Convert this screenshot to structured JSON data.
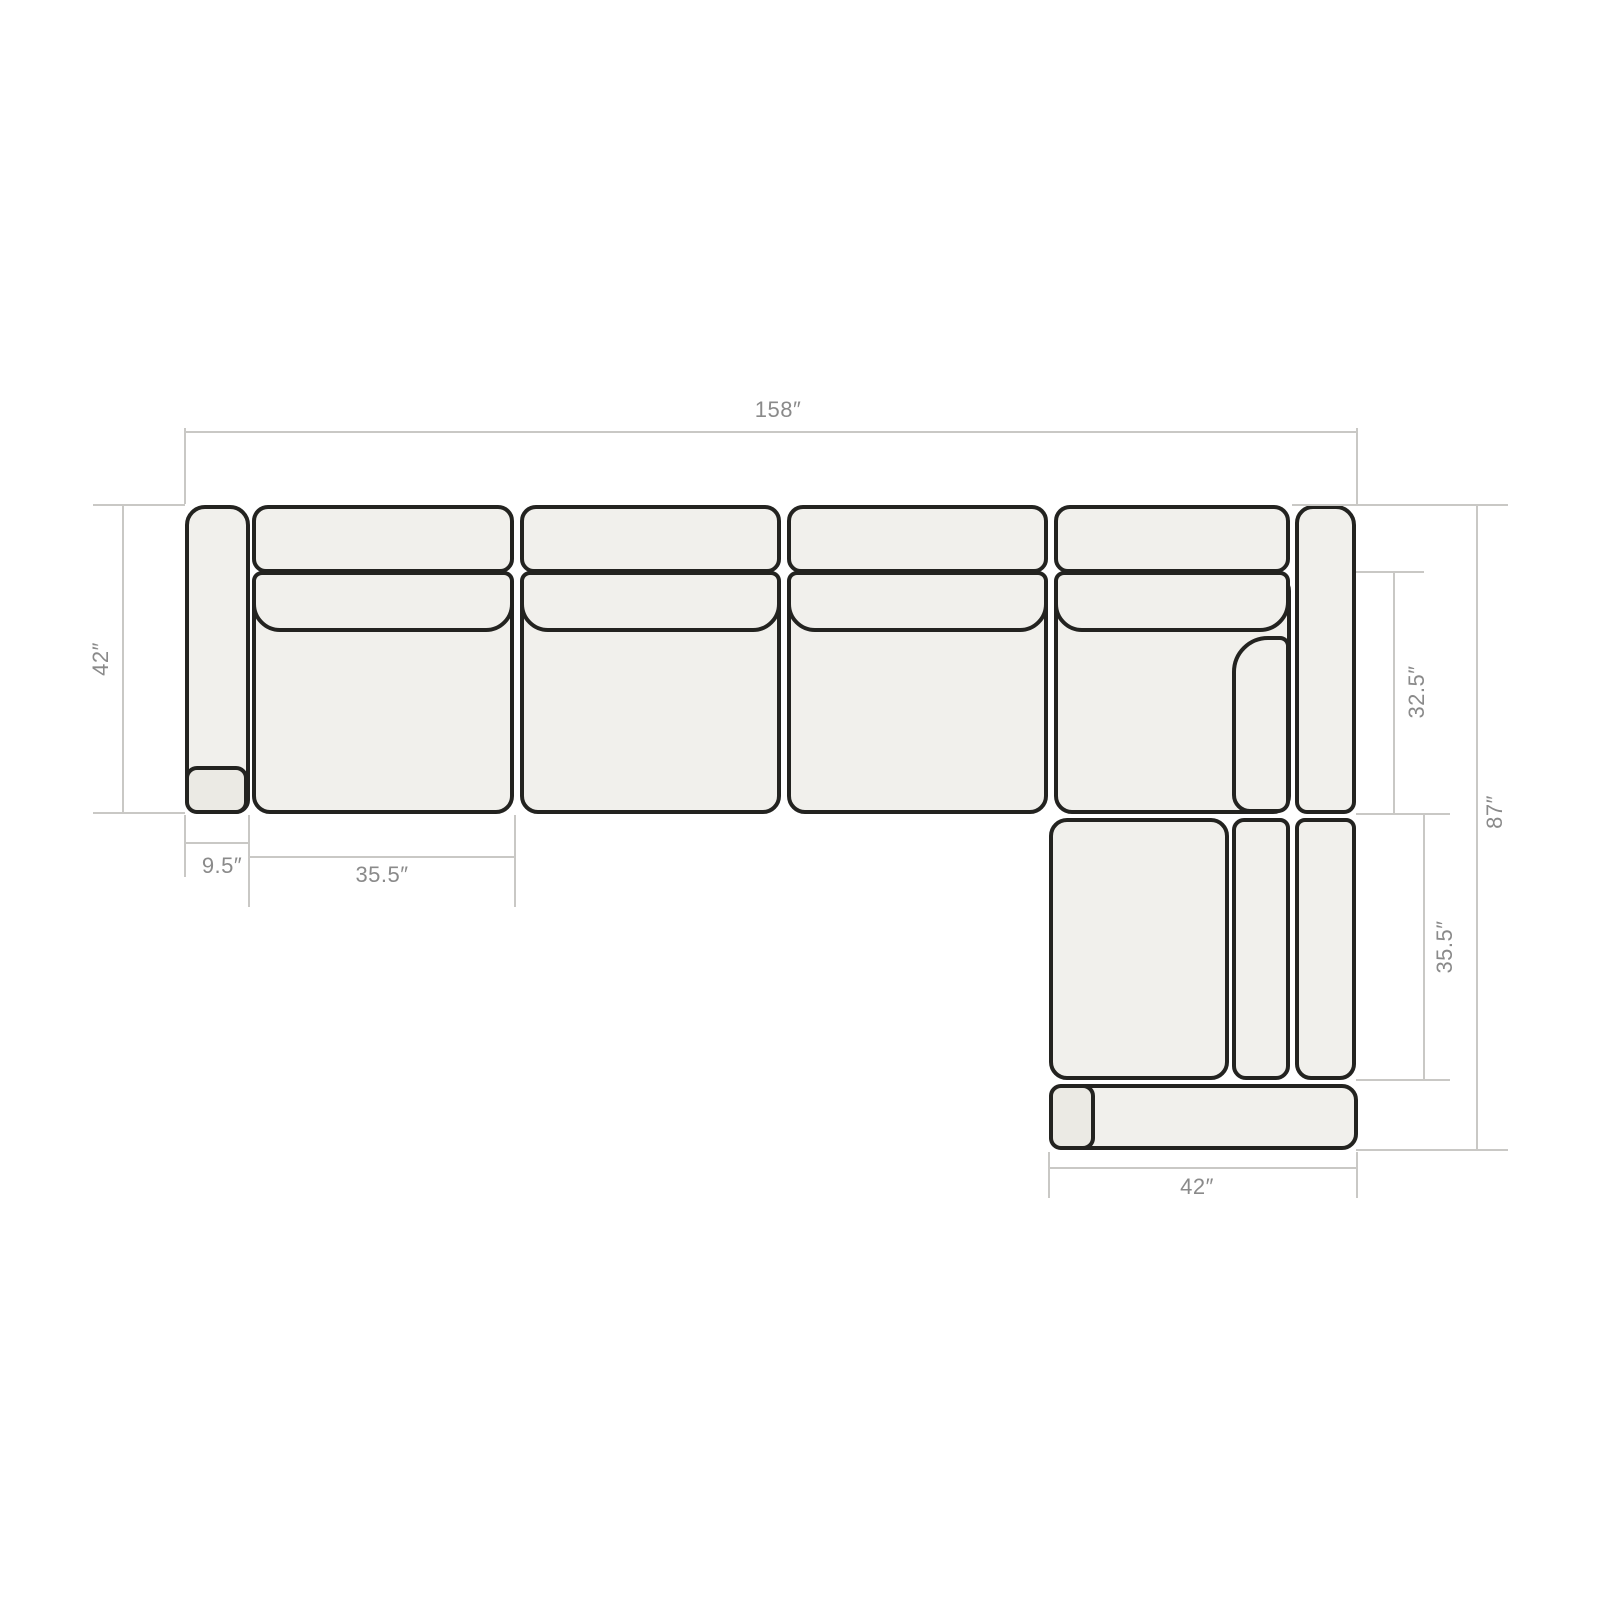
{
  "diagram": {
    "type": "sectional-sofa-top-view-dimension-diagram",
    "units": "inches",
    "description": "Top-down outline drawing of an L-shaped sectional sofa with dimension lines"
  },
  "colors": {
    "background": "#ffffff",
    "piece_fill": "#f1f0ec",
    "piece_fill_accent": "#ebeae4",
    "outline": "#232320",
    "dimension_line": "#c9c8c5",
    "dimension_text": "#8a8a8a"
  },
  "dimensions": {
    "total_width": {
      "label": "158″",
      "value": 158,
      "edge": "top"
    },
    "sofa_depth": {
      "label": "42″",
      "value": 42,
      "edge": "left"
    },
    "arm_width": {
      "label": "9.5″",
      "value": 9.5,
      "edge": "bottom-left"
    },
    "seat_width": {
      "label": "35.5″",
      "value": 35.5,
      "edge": "bottom-left"
    },
    "corner_seat_depth": {
      "label": "32.5″",
      "value": 32.5,
      "edge": "right"
    },
    "chaise_seat_length": {
      "label": "35.5″",
      "value": 35.5,
      "edge": "right"
    },
    "total_depth": {
      "label": "87″",
      "value": 87,
      "edge": "right"
    },
    "chaise_width": {
      "label": "42″",
      "value": 42,
      "edge": "bottom"
    }
  }
}
